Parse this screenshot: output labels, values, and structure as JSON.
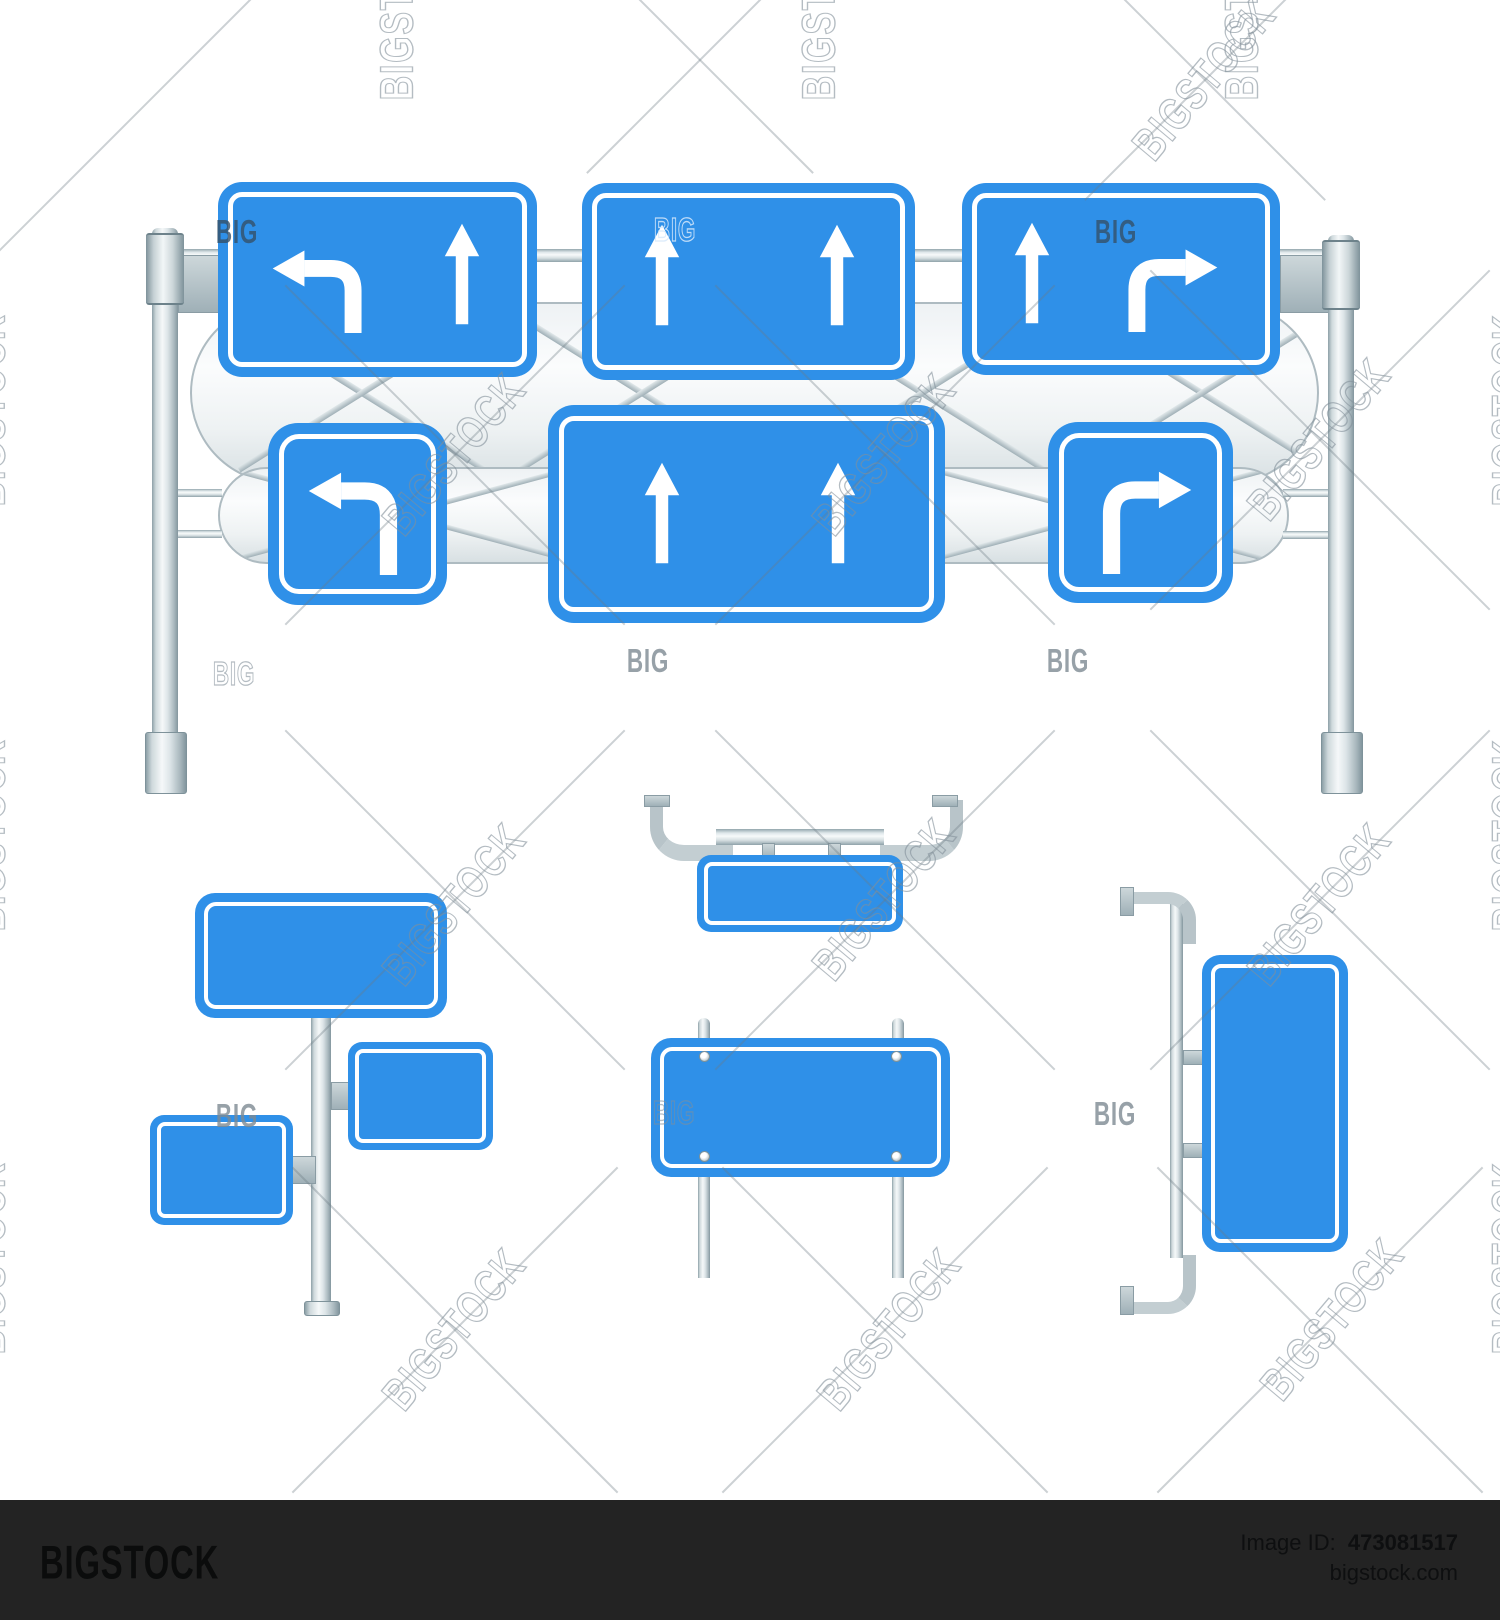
{
  "footer": {
    "logo": "BIGSTOCK",
    "image_id_label": "Image ID:",
    "image_id_value": "473081517",
    "domain": "bigstock.com"
  },
  "watermark": {
    "word": "BIG",
    "word_full": "BIGSTOCK"
  },
  "colors": {
    "sign_blue": "#2F90E8",
    "sign_inner_border": "#FFFFFF",
    "arrow_white": "#FFFFFF",
    "metal_highlight": "#F5F8F9",
    "metal_mid": "#C9D3D7",
    "metal_shadow": "#83969E",
    "footer_bg": "#232323",
    "footer_text": "#0E0F10",
    "background": "#FFFFFF"
  },
  "icons": [
    {
      "name": "left-turn-arrow-icon",
      "meaning": "lane turns left"
    },
    {
      "name": "straight-arrow-icon",
      "meaning": "lane goes straight"
    },
    {
      "name": "right-turn-arrow-icon",
      "meaning": "lane turns right"
    }
  ],
  "gantry": {
    "row1_signs": [
      {
        "shape": "rectangle",
        "arrows": [
          "left-turn",
          "straight"
        ]
      },
      {
        "shape": "rectangle",
        "arrows": [
          "straight",
          "straight"
        ]
      },
      {
        "shape": "rectangle",
        "arrows": [
          "straight",
          "right-turn"
        ]
      }
    ],
    "row2_signs": [
      {
        "shape": "square",
        "arrows": [
          "left-turn"
        ]
      },
      {
        "shape": "wide-rectangle",
        "arrows": [
          "straight",
          "straight"
        ]
      },
      {
        "shape": "square",
        "arrows": [
          "right-turn"
        ]
      }
    ]
  },
  "standalone_groups": [
    {
      "name": "single-pole-three-blank-signs"
    },
    {
      "name": "hanging-bracket-blank-sign"
    },
    {
      "name": "two-post-blank-sign"
    },
    {
      "name": "side-pole-vertical-blank-sign"
    }
  ]
}
